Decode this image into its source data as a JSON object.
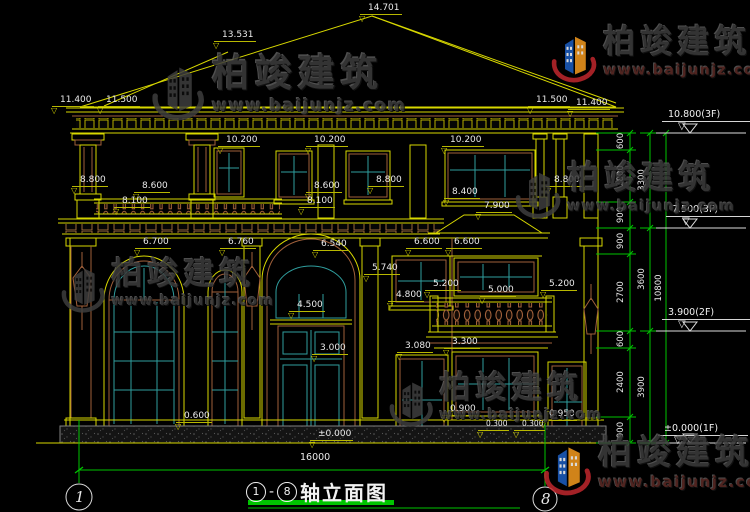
{
  "drawing": {
    "title": {
      "axis_start": "1",
      "dash": "-",
      "axis_end": "8",
      "name": "轴立面图"
    },
    "total_width_label": "16000",
    "axis_bubbles": {
      "left": "1",
      "right": "8"
    },
    "elevation_markers": [
      {
        "label": "10.800(3F)",
        "x": 662,
        "y": 109
      },
      {
        "label": "7.500(3F)",
        "x": 666,
        "y": 204
      },
      {
        "label": "3.900(2F)",
        "x": 662,
        "y": 307
      },
      {
        "label": "±0.000(1F)",
        "x": 658,
        "y": 423
      }
    ],
    "dims": [
      {
        "v": "14.701",
        "x": 360,
        "y": 3
      },
      {
        "v": "13.531",
        "x": 214,
        "y": 30
      },
      {
        "v": "11.400",
        "x": 52,
        "y": 95
      },
      {
        "v": "11.500",
        "x": 98,
        "y": 95
      },
      {
        "v": "11.500",
        "x": 528,
        "y": 95
      },
      {
        "v": "11.400",
        "x": 568,
        "y": 98
      },
      {
        "v": "10.200",
        "x": 218,
        "y": 135
      },
      {
        "v": "10.200",
        "x": 306,
        "y": 135
      },
      {
        "v": "10.200",
        "x": 442,
        "y": 135
      },
      {
        "v": "8.800",
        "x": 72,
        "y": 175
      },
      {
        "v": "8.800",
        "x": 368,
        "y": 175
      },
      {
        "v": "8.800",
        "x": 546,
        "y": 175
      },
      {
        "v": "8.600",
        "x": 134,
        "y": 181
      },
      {
        "v": "8.600",
        "x": 306,
        "y": 181
      },
      {
        "v": "8.100",
        "x": 114,
        "y": 196
      },
      {
        "v": "8.100",
        "x": 299,
        "y": 196
      },
      {
        "v": "8.400",
        "x": 444,
        "y": 187
      },
      {
        "v": "7.900",
        "x": 476,
        "y": 201
      },
      {
        "v": "6.700",
        "x": 135,
        "y": 237
      },
      {
        "v": "6.760",
        "x": 220,
        "y": 237
      },
      {
        "v": "6.540",
        "x": 313,
        "y": 239
      },
      {
        "v": "5.740",
        "x": 364,
        "y": 263
      },
      {
        "v": "6.600",
        "x": 406,
        "y": 237
      },
      {
        "v": "6.600",
        "x": 446,
        "y": 237
      },
      {
        "v": "5.200",
        "x": 425,
        "y": 279
      },
      {
        "v": "5.000",
        "x": 480,
        "y": 285
      },
      {
        "v": "5.200",
        "x": 541,
        "y": 279
      },
      {
        "v": "4.800",
        "x": 388,
        "y": 290
      },
      {
        "v": "4.500",
        "x": 289,
        "y": 300
      },
      {
        "v": "3.300",
        "x": 444,
        "y": 337
      },
      {
        "v": "3.080",
        "x": 397,
        "y": 341
      },
      {
        "v": "3.000",
        "x": 312,
        "y": 343
      },
      {
        "v": "0.900",
        "x": 442,
        "y": 404
      },
      {
        "v": "0.600",
        "x": 176,
        "y": 411
      },
      {
        "v": "0.300",
        "x": 478,
        "y": 419,
        "s": 7.5
      },
      {
        "v": "0.300",
        "x": 514,
        "y": 419,
        "s": 7.5
      },
      {
        "v": "0.950",
        "x": 541,
        "y": 409
      },
      {
        "v": "±0.000",
        "x": 310,
        "y": 429
      }
    ],
    "chain_dims": [
      {
        "v": "600",
        "x": 621,
        "y": 141
      },
      {
        "v": "1800",
        "x": 621,
        "y": 176
      },
      {
        "v": "900",
        "x": 621,
        "y": 215
      },
      {
        "v": "900",
        "x": 621,
        "y": 241
      },
      {
        "v": "2700",
        "x": 621,
        "y": 292
      },
      {
        "v": "600",
        "x": 621,
        "y": 339
      },
      {
        "v": "2400",
        "x": 621,
        "y": 382
      },
      {
        "v": "900",
        "x": 621,
        "y": 430
      },
      {
        "v": "3300",
        "x": 642,
        "y": 180
      },
      {
        "v": "3600",
        "x": 642,
        "y": 279
      },
      {
        "v": "3900",
        "x": 642,
        "y": 387
      },
      {
        "v": "10800",
        "x": 659,
        "y": 288
      }
    ]
  },
  "brand": {
    "name": "柏竣建筑",
    "url": "www.baijunjz.com"
  },
  "watermarks": [
    {
      "style": "dark",
      "x": 148,
      "y": 55,
      "s": 1.1
    },
    {
      "style": "color",
      "x": 548,
      "y": 26,
      "s": 0.95
    },
    {
      "style": "dark",
      "x": 58,
      "y": 258,
      "s": 0.92
    },
    {
      "style": "dark",
      "x": 512,
      "y": 162,
      "s": 0.95
    },
    {
      "style": "dark",
      "x": 386,
      "y": 372,
      "s": 0.92
    },
    {
      "style": "color",
      "x": 540,
      "y": 436,
      "s": 1.0
    }
  ],
  "colors": {
    "background": "#000000",
    "line_yellow": "#d8d800",
    "line_green": "#00c400",
    "glass_teal": "#2f9e9e",
    "frame_brown": "#a0603a",
    "text_white": "#e8e8e8"
  }
}
